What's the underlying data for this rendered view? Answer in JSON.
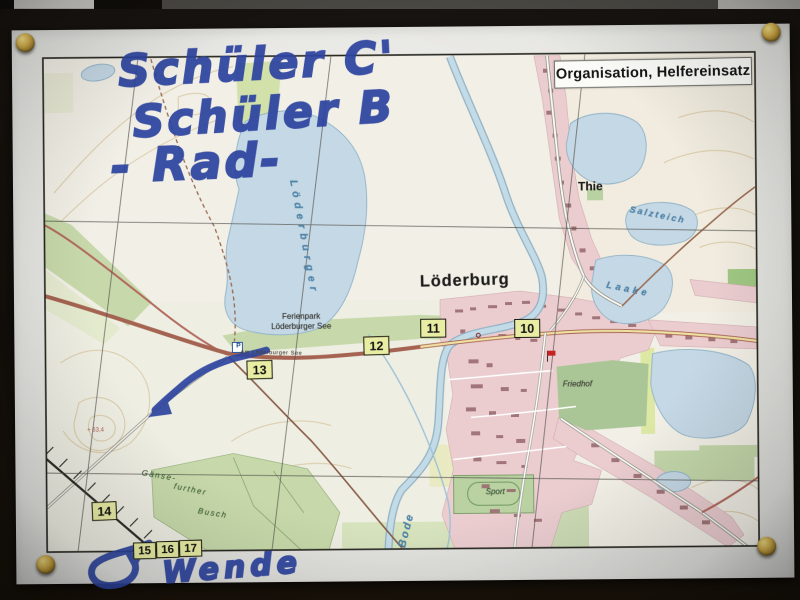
{
  "photo": {
    "handwriting": {
      "line1": "Schüler C'",
      "line2": "Schüler B",
      "line3": "- Rad-",
      "turn_note": "Wende",
      "ink_color": "#2c44a4"
    },
    "pin_count": 4,
    "pin_color": "#d4ad45"
  },
  "map": {
    "title_box_label": "Organisation, Helfereinsatz",
    "place_labels": {
      "town": "Löderburg",
      "district": "Thie",
      "ferienpark_line1": "Ferienpark",
      "ferienpark_line2": "Löderburger See",
      "street": "Am Löderburger See",
      "lake_vertical": "Löderburger",
      "pond_salzteich": "Salzteich",
      "pond_laake": "Laake",
      "river": "Bode",
      "cemetery": "Friedhof",
      "sports_field": "Sport",
      "forest_line1": "Gänse-",
      "forest_line2": "further",
      "forest_line3": "Busch",
      "parking": "P"
    },
    "route_markers": [
      {
        "label": "10"
      },
      {
        "label": "11"
      },
      {
        "label": "12"
      },
      {
        "label": "13"
      },
      {
        "label": "14"
      },
      {
        "label": "15"
      },
      {
        "label": "16"
      },
      {
        "label": "17"
      }
    ],
    "colors": {
      "water": "#c4d8e6",
      "forest": "#c6d9a8",
      "settlement": "#eccdd0",
      "marker_box": "#e9eda0",
      "map_sheet": "#f2efe6"
    }
  }
}
